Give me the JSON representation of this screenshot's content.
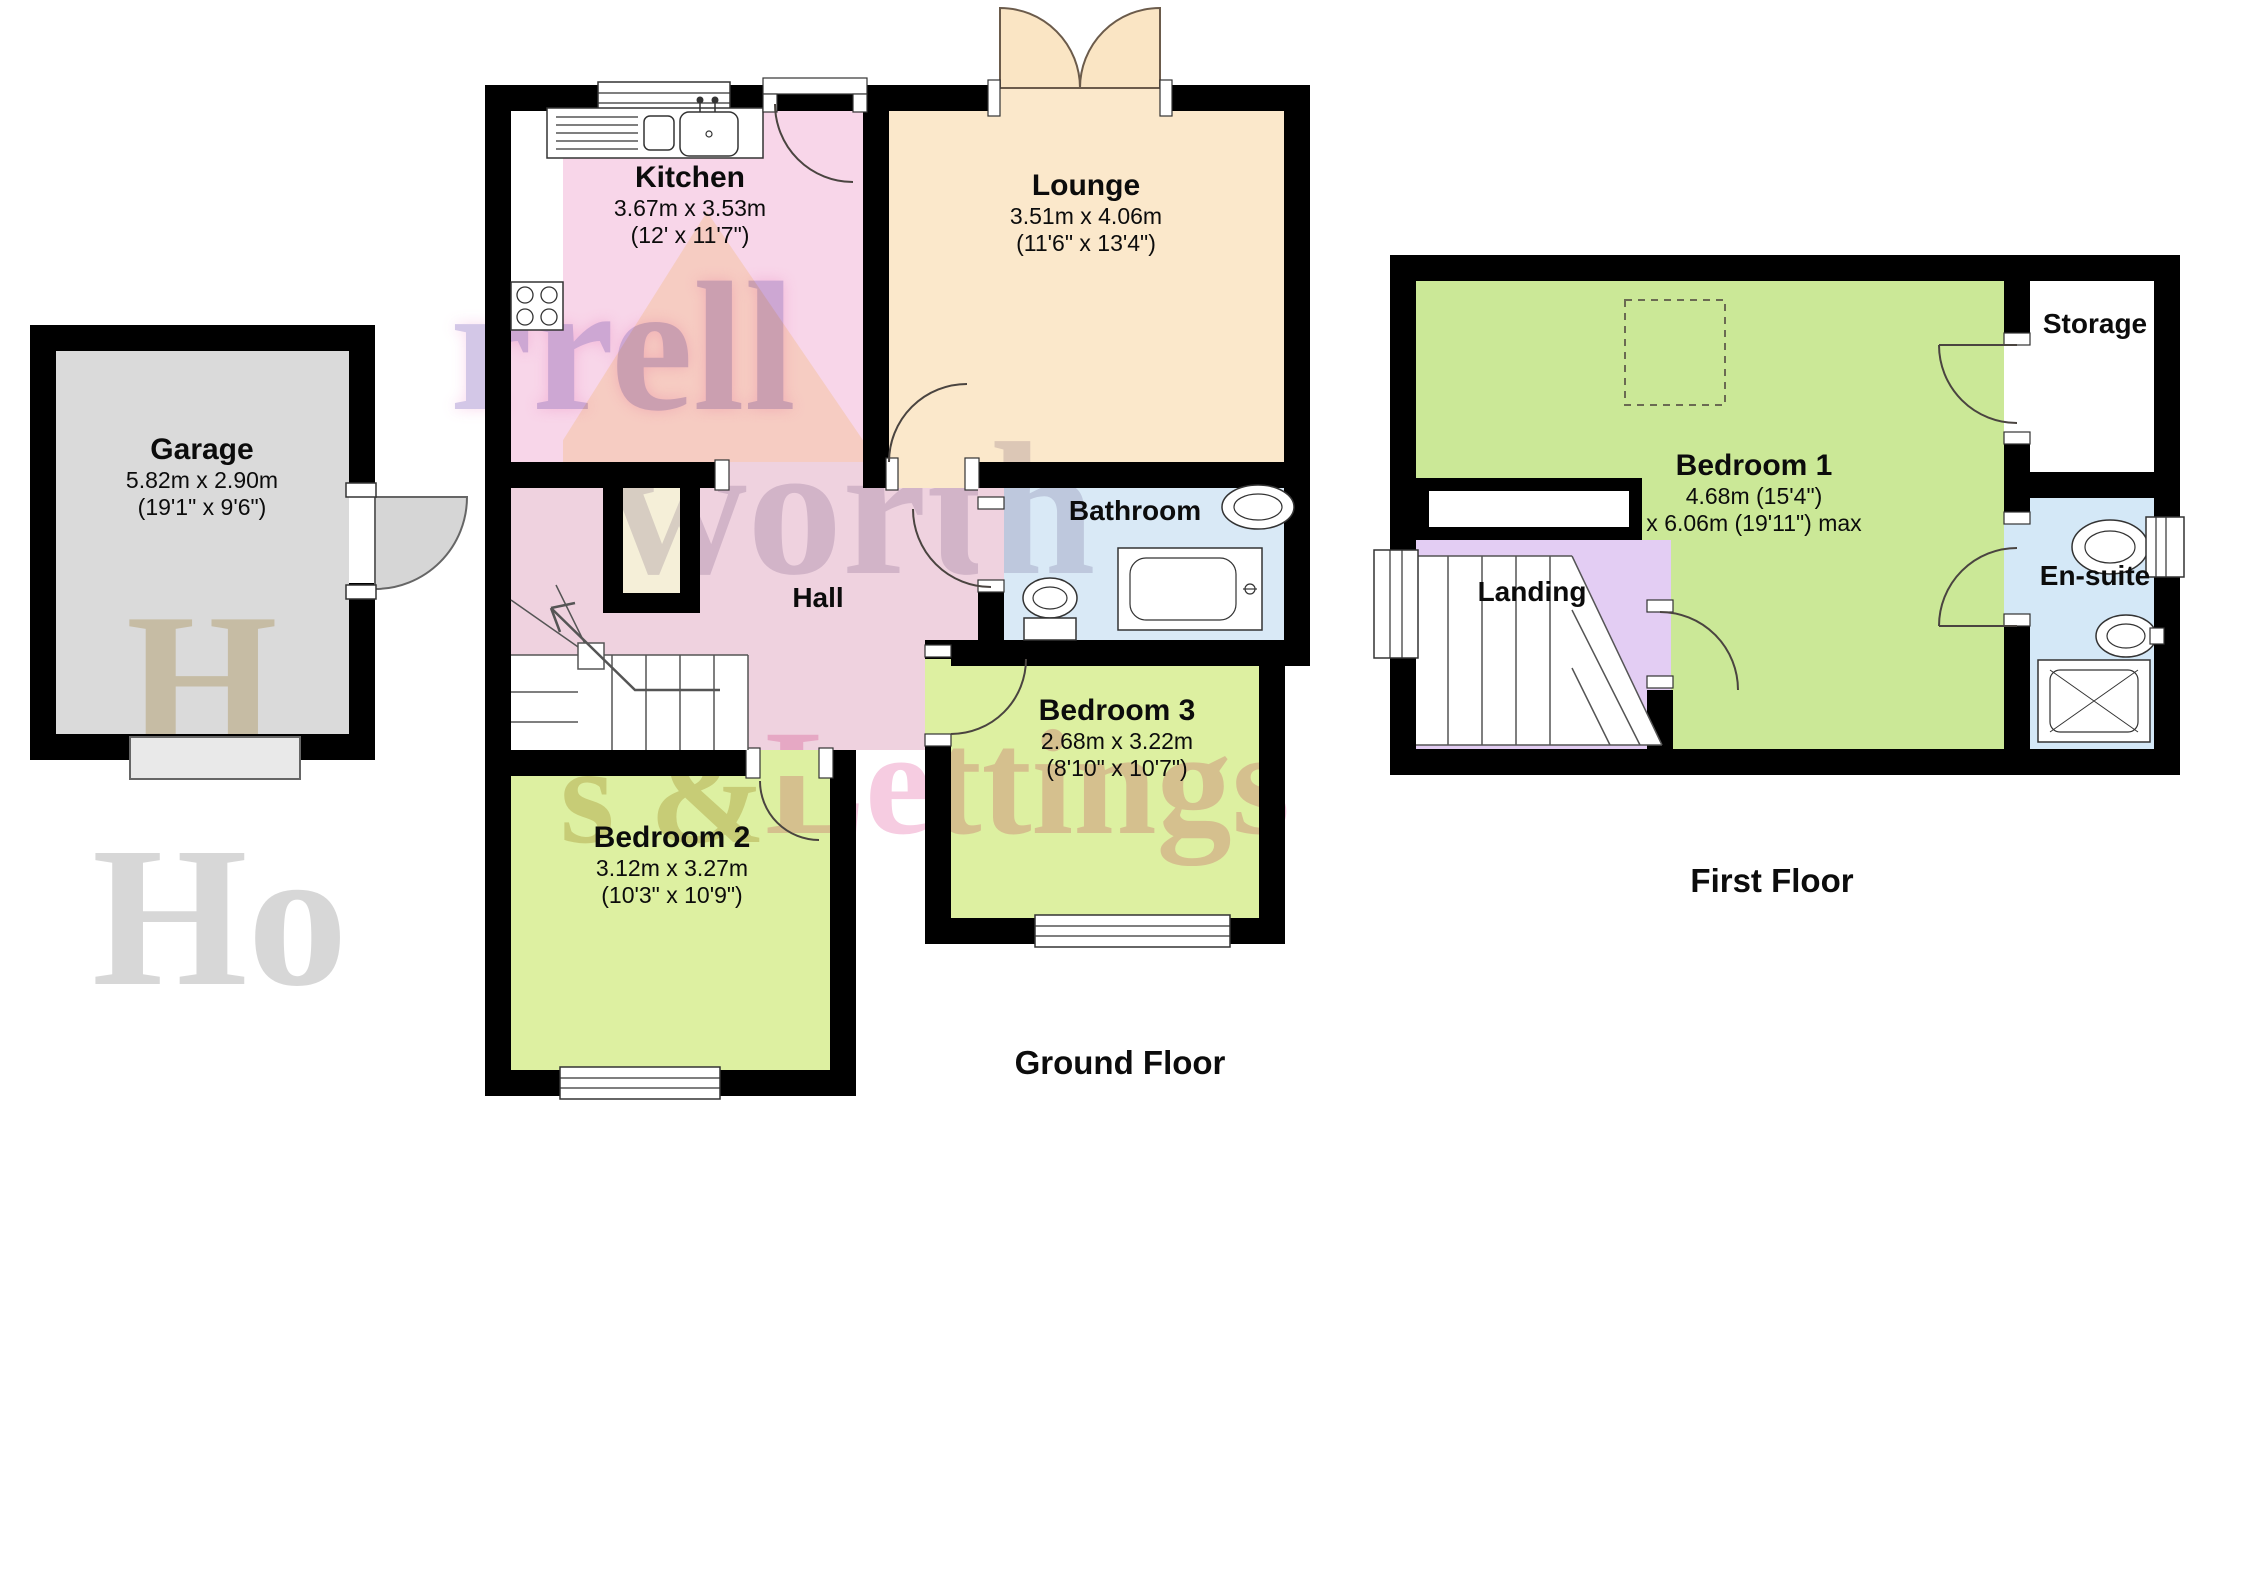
{
  "floors": {
    "ground": {
      "title": "Ground Floor"
    },
    "first": {
      "title": "First Floor"
    }
  },
  "rooms": {
    "garage": {
      "name": "Garage",
      "metric": "5.82m x 2.90m",
      "imperial": "(19'1\" x 9'6\")"
    },
    "kitchen": {
      "name": "Kitchen",
      "metric": "3.67m x 3.53m",
      "imperial": "(12' x 11'7\")"
    },
    "lounge": {
      "name": "Lounge",
      "metric": "3.51m x 4.06m",
      "imperial": "(11'6\" x 13'4\")"
    },
    "bathroom": {
      "name": "Bathroom"
    },
    "hall": {
      "name": "Hall"
    },
    "bedroom2": {
      "name": "Bedroom 2",
      "metric": "3.12m x 3.27m",
      "imperial": "(10'3\" x 10'9\")"
    },
    "bedroom3": {
      "name": "Bedroom 3",
      "metric": "2.68m x 3.22m",
      "imperial": "(8'10\" x 10'7\")"
    },
    "bedroom1": {
      "name": "Bedroom 1",
      "metric": "4.68m (15'4\")",
      "imperial": "x 6.06m (19'11\") max"
    },
    "landing": {
      "name": "Landing"
    },
    "storage": {
      "name": "Storage"
    },
    "ensuite": {
      "name": "En-suite"
    }
  },
  "watermark": {
    "pieces": [
      {
        "text": "rrell"
      },
      {
        "text": "worth"
      },
      {
        "text": "s &"
      },
      {
        "text": "Lettings"
      },
      {
        "text": "H"
      },
      {
        "text": "Ho"
      }
    ]
  },
  "colors": {
    "wall": "#000000",
    "garage": "#DADADA",
    "kitchen": "#F8D6E9",
    "lounge": "#FBE8CB",
    "bathroom": "#D9E9F6",
    "hall": "#EFD2DF",
    "bedroom_green": "#DDF0A1",
    "bedroom1_green": "#CBE897",
    "landing": "#E3CDF3",
    "ensuite": "#D4E8F7"
  }
}
